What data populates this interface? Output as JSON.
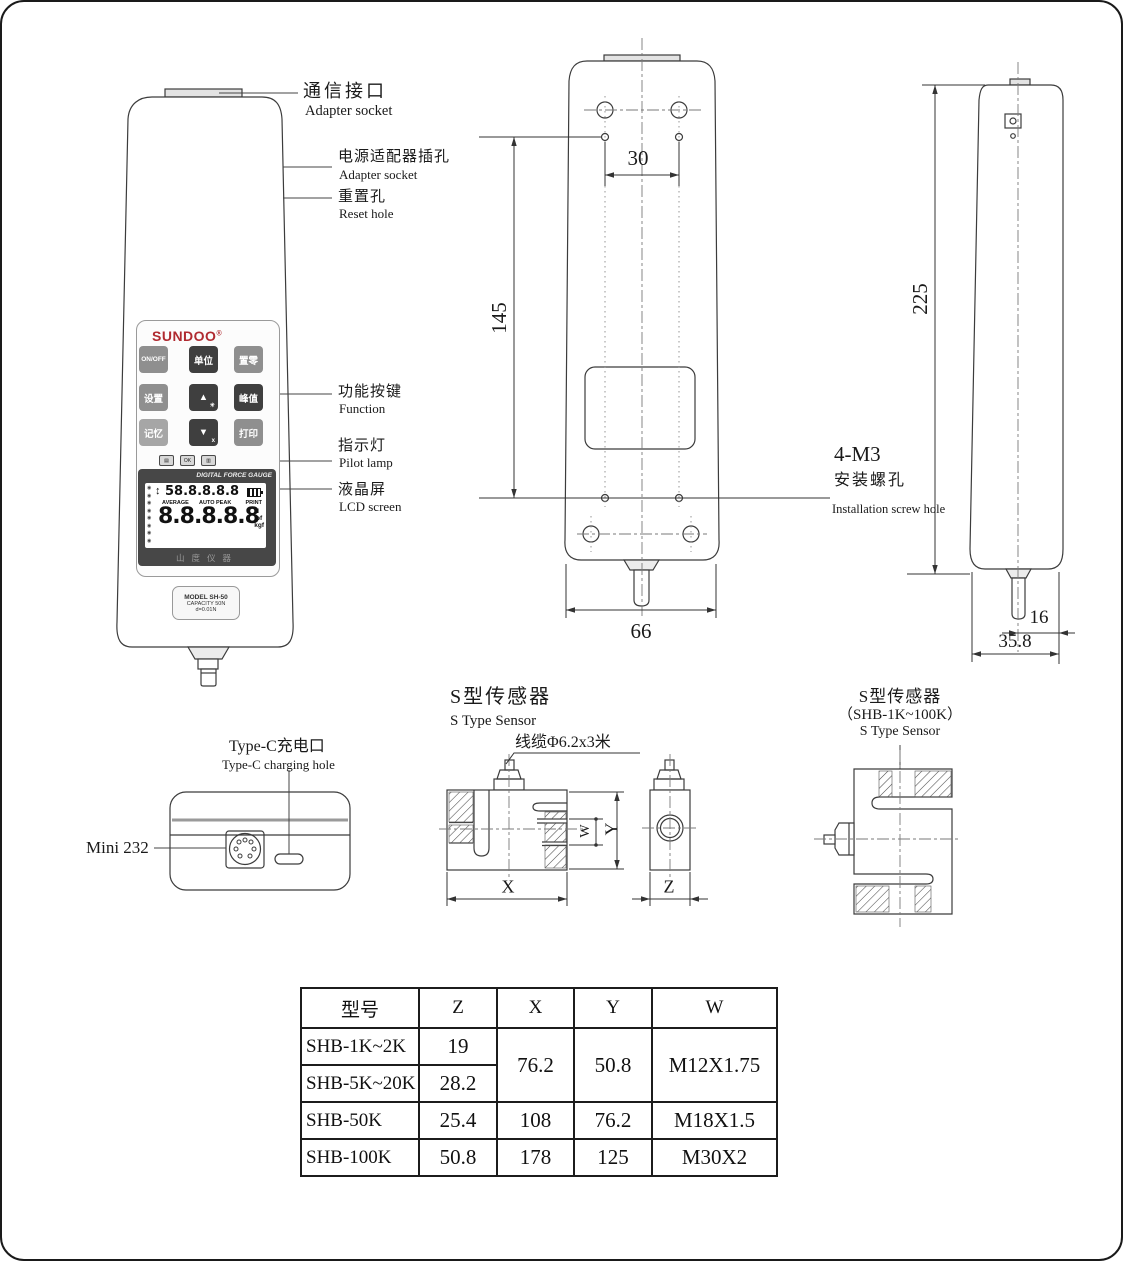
{
  "front_view": {
    "brand": "SUNDOO",
    "brand_reg": "®",
    "keypad_buttons": [
      {
        "label": "ON/OFF",
        "sub": ""
      },
      {
        "label": "单位",
        "sub": ""
      },
      {
        "label": "置零",
        "sub": ""
      },
      {
        "label": "设置",
        "sub": ""
      },
      {
        "label": "▲",
        "sub": "☀"
      },
      {
        "label": "峰值",
        "sub": ""
      },
      {
        "label": "记忆",
        "sub": ""
      },
      {
        "label": "▼",
        "sub": "x"
      },
      {
        "label": "打印",
        "sub": ""
      }
    ],
    "indicator_badges": [
      "▤",
      "OK",
      "▥"
    ],
    "lcd": {
      "header": "DIGITAL FORCE GAUGE",
      "side_icon": "◉",
      "arrow": "↕",
      "top_reading": "58.8.8.8.8",
      "status_left": "AVERAGE",
      "status_mid": "AUTO PEAK",
      "status_right": "PRINT",
      "main_reading": "8.8.8.8.8",
      "unit_n": "N",
      "unit_lbf": "lbf",
      "unit_kgf": "kgf",
      "footer": "山度仪器"
    },
    "model_label_1": "MODEL SH-50",
    "model_label_2": "CAPACITY 50N",
    "model_label_3": "d=0.01N"
  },
  "callouts": {
    "comm_zh": "通信接口",
    "comm_en": "Adapter socket",
    "adapter_zh": "电源适配器插孔",
    "adapter_en": "Adapter socket",
    "reset_zh": "重置孔",
    "reset_en": "Reset hole",
    "function_zh": "功能按键",
    "function_en": "Function",
    "pilot_zh": "指示灯",
    "pilot_en": "Pilot lamp",
    "lcd_zh": "液晶屏",
    "lcd_en": "LCD screen",
    "screw_title": "4-M3",
    "screw_zh": "安装螺孔",
    "screw_en": "Installation screw hole",
    "typec_zh": "Type-C充电口",
    "typec_en": "Type-C charging hole",
    "mini232": "Mini 232"
  },
  "dims": {
    "hole_spacing": "30",
    "rear_height": "145",
    "rear_width": "66",
    "side_height": "225",
    "shaft_offset": "16",
    "side_width": "35.8"
  },
  "sensor_front": {
    "title_zh": "S型传感器",
    "title_en": "S Type Sensor",
    "cable_label": "线缆Φ6.2x3米",
    "dim_x": "X",
    "dim_y": "Y",
    "dim_w": "W",
    "dim_z": "Z"
  },
  "sensor_side": {
    "title_zh": "S型传感器",
    "title_range": "（SHB-1K~100K）",
    "title_en": "S Type Sensor"
  },
  "spec_table": {
    "headers": [
      "型号",
      "Z",
      "X",
      "Y",
      "W"
    ],
    "rows": [
      {
        "model": "SHB-1K~2K",
        "z": "19",
        "x": "76.2",
        "y": "50.8",
        "w": "M12X1.75"
      },
      {
        "model": "SHB-5K~20K",
        "z": "28.2"
      },
      {
        "model": "SHB-50K",
        "z": "25.4",
        "x": "108",
        "y": "76.2",
        "w": "M18X1.5"
      },
      {
        "model": "SHB-100K",
        "z": "50.8",
        "x": "178",
        "y": "125",
        "w": "M30X2"
      }
    ]
  }
}
